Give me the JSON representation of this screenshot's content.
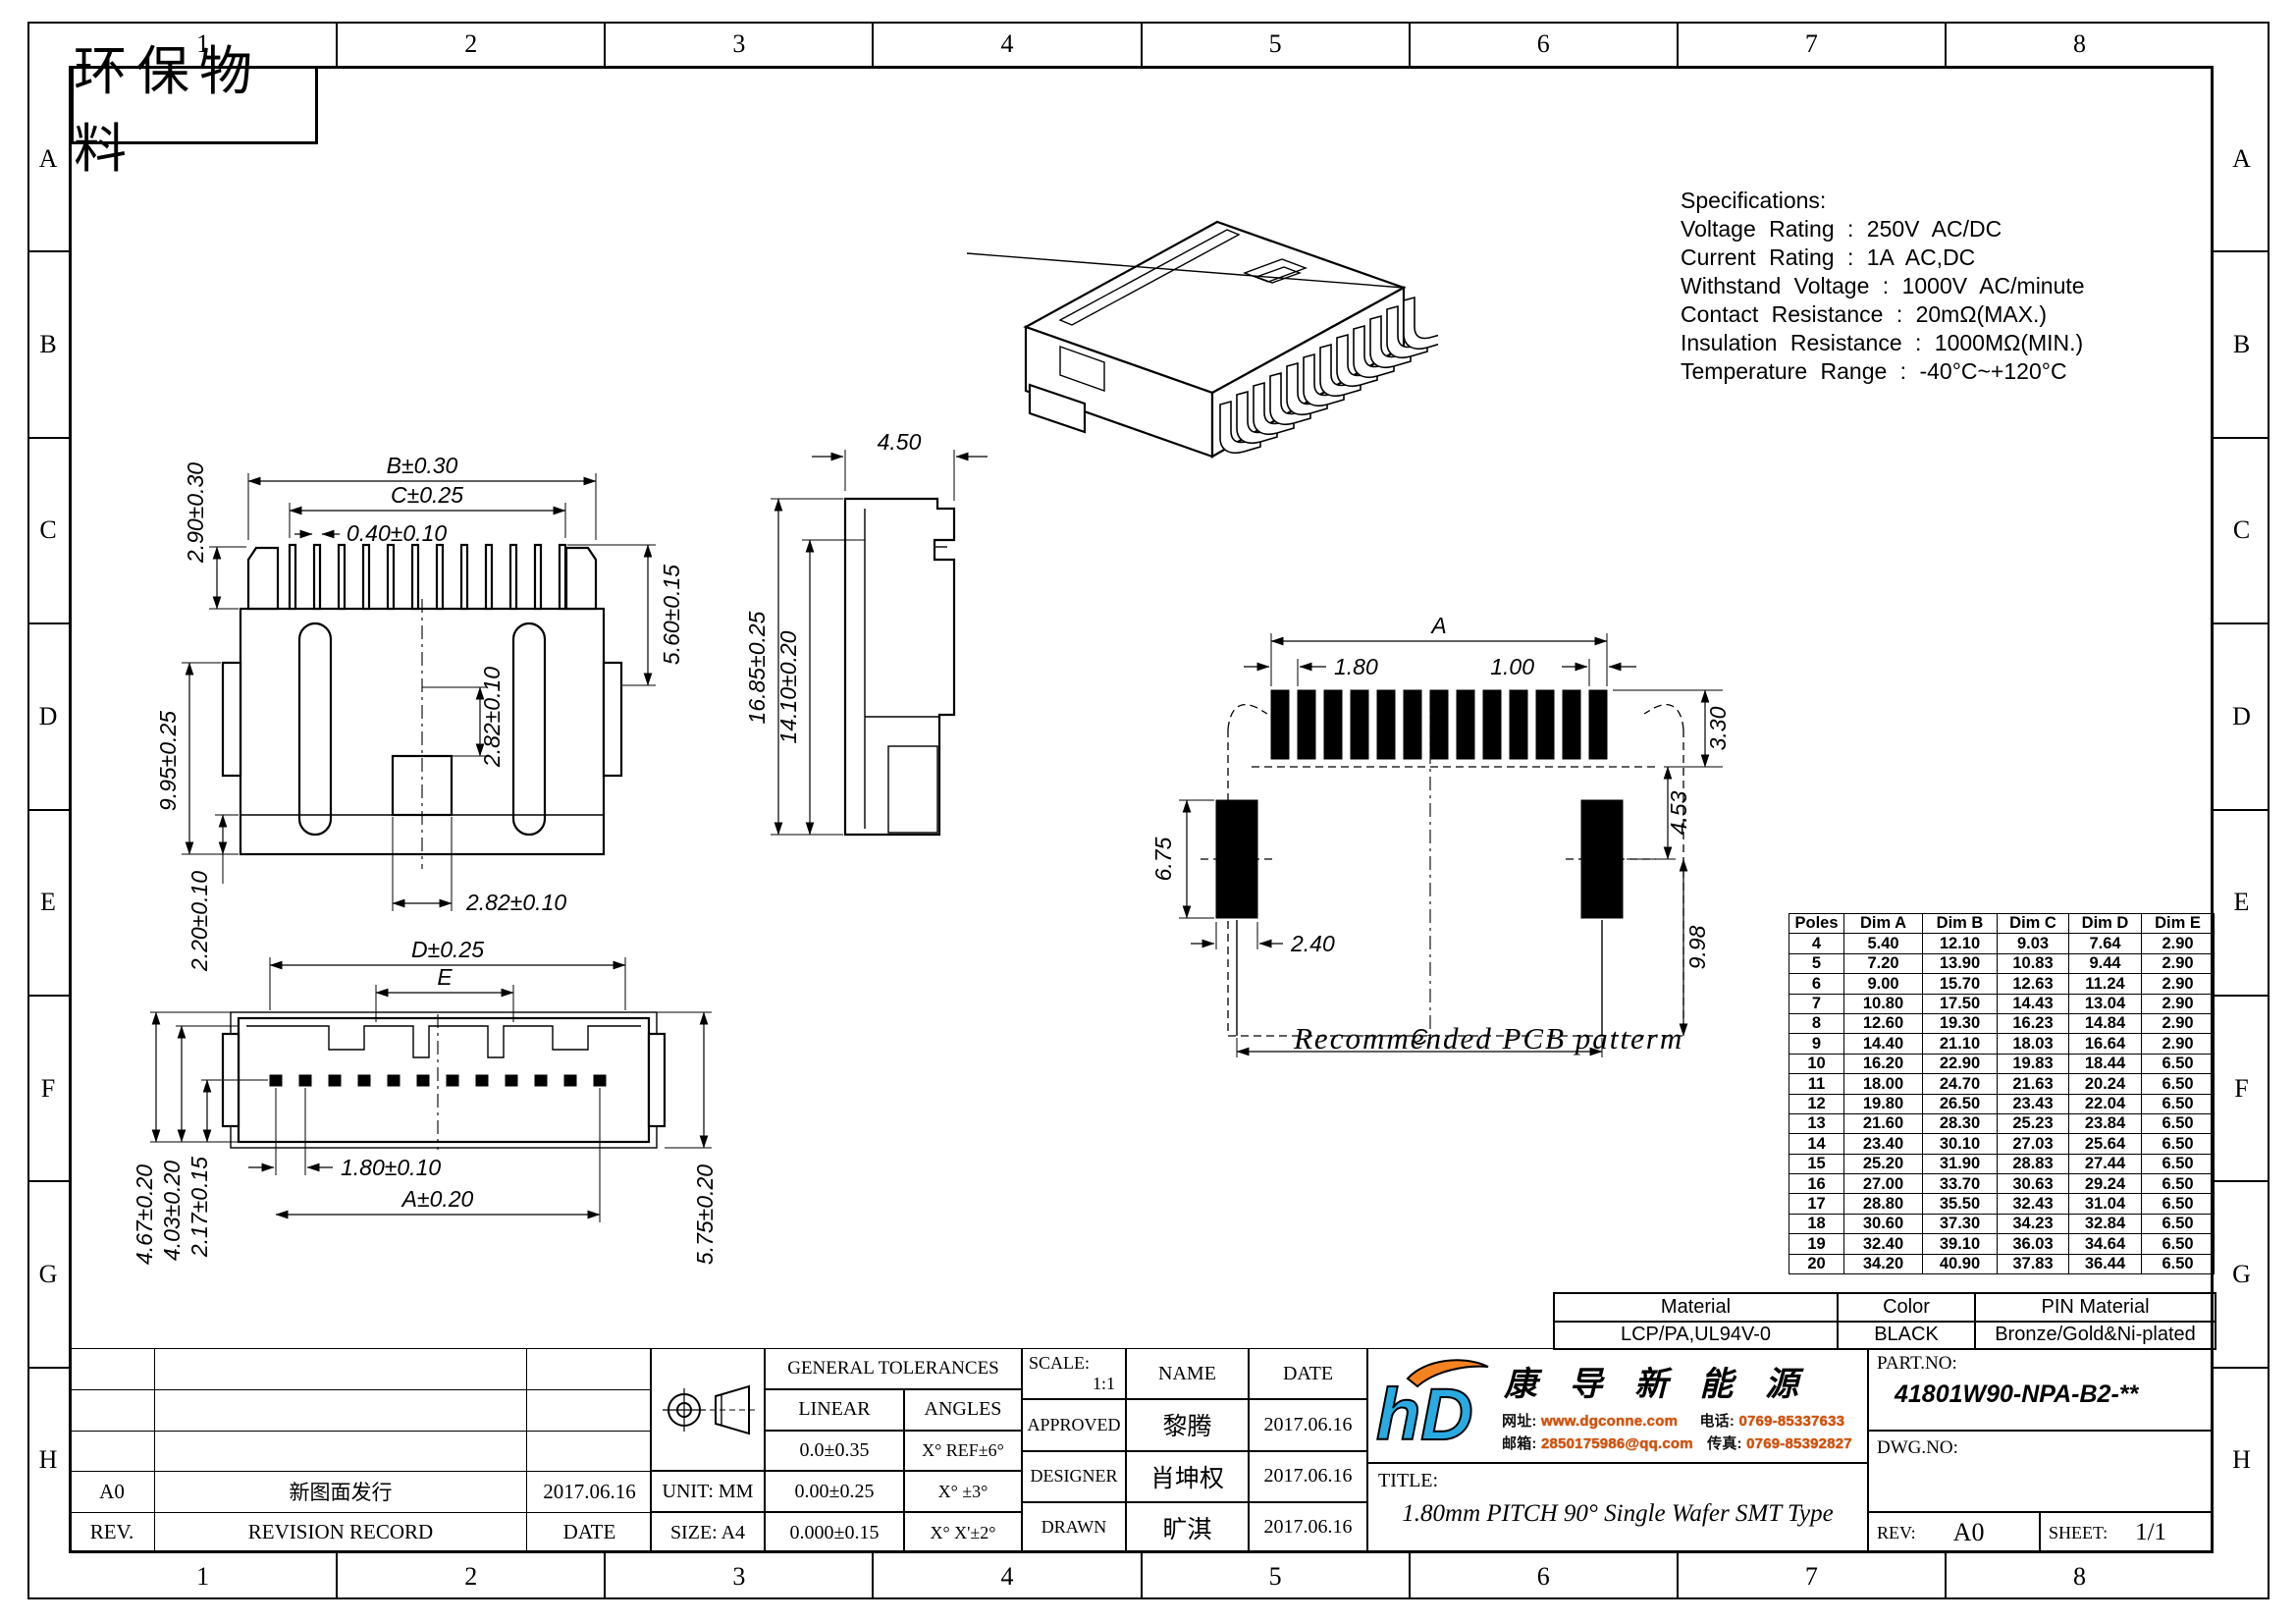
{
  "frame": {
    "columns": [
      "1",
      "2",
      "3",
      "4",
      "5",
      "6",
      "7",
      "8"
    ],
    "rows": [
      "A",
      "B",
      "C",
      "D",
      "E",
      "F",
      "G",
      "H"
    ]
  },
  "stamp": "环保物料",
  "specifications": {
    "title": "Specifications:",
    "lines": [
      "Voltage Rating : 250V AC/DC",
      "Current Rating : 1A AC,DC",
      "Withstand Voltage : 1000V AC/minute",
      "Contact Resistance : 20mΩ(MAX.)",
      "Insulation Resistance : 1000MΩ(MIN.)",
      "Temperature Range : -40°C~+120°C"
    ]
  },
  "views": {
    "front": {
      "dims": {
        "b": "B±0.30",
        "c": "C±0.25",
        "pin_w": "0.40±0.10",
        "top_h": "2.90±0.30",
        "latch_h": "5.60±0.15",
        "slot_v": "2.82±0.10",
        "body_h": "9.95±0.25",
        "foot_h": "2.20±0.10",
        "slot_w": "2.82±0.10"
      }
    },
    "side": {
      "dims": {
        "w": "4.50",
        "h_total": "16.85±0.25",
        "h_inner": "14.10±0.20"
      }
    },
    "bottom": {
      "dims": {
        "d": "D±0.25",
        "e": "E",
        "pitch": "1.80±0.10",
        "a": "A±0.20",
        "v1": "4.67±0.20",
        "v2": "4.03±0.20",
        "v3": "2.17±0.15",
        "v4": "5.75±0.20"
      }
    },
    "pcb": {
      "dims": {
        "a": "A",
        "pitch": "1.80",
        "pad_w": "1.00",
        "pad_h": "3.30",
        "gap": "4.53",
        "side_pad_h": "6.75",
        "side_pad_w": "2.40",
        "depth": "9.98",
        "c": "C"
      },
      "caption": "Recommended PCB patterm"
    }
  },
  "poles_table": {
    "headers": [
      "Poles",
      "Dim A",
      "Dim B",
      "Dim C",
      "Dim D",
      "Dim E"
    ],
    "rows": [
      [
        "4",
        "5.40",
        "12.10",
        "9.03",
        "7.64",
        "2.90"
      ],
      [
        "5",
        "7.20",
        "13.90",
        "10.83",
        "9.44",
        "2.90"
      ],
      [
        "6",
        "9.00",
        "15.70",
        "12.63",
        "11.24",
        "2.90"
      ],
      [
        "7",
        "10.80",
        "17.50",
        "14.43",
        "13.04",
        "2.90"
      ],
      [
        "8",
        "12.60",
        "19.30",
        "16.23",
        "14.84",
        "2.90"
      ],
      [
        "9",
        "14.40",
        "21.10",
        "18.03",
        "16.64",
        "2.90"
      ],
      [
        "10",
        "16.20",
        "22.90",
        "19.83",
        "18.44",
        "6.50"
      ],
      [
        "11",
        "18.00",
        "24.70",
        "21.63",
        "20.24",
        "6.50"
      ],
      [
        "12",
        "19.80",
        "26.50",
        "23.43",
        "22.04",
        "6.50"
      ],
      [
        "13",
        "21.60",
        "28.30",
        "25.23",
        "23.84",
        "6.50"
      ],
      [
        "14",
        "23.40",
        "30.10",
        "27.03",
        "25.64",
        "6.50"
      ],
      [
        "15",
        "25.20",
        "31.90",
        "28.83",
        "27.44",
        "6.50"
      ],
      [
        "16",
        "27.00",
        "33.70",
        "30.63",
        "29.24",
        "6.50"
      ],
      [
        "17",
        "28.80",
        "35.50",
        "32.43",
        "31.04",
        "6.50"
      ],
      [
        "18",
        "30.60",
        "37.30",
        "34.23",
        "32.84",
        "6.50"
      ],
      [
        "19",
        "32.40",
        "39.10",
        "36.03",
        "34.64",
        "6.50"
      ],
      [
        "20",
        "34.20",
        "40.90",
        "37.83",
        "36.44",
        "6.50"
      ]
    ]
  },
  "material_table": {
    "headers": [
      "Material",
      "Color",
      "PIN Material"
    ],
    "values": [
      "LCP/PA,UL94V-0",
      "BLACK",
      "Bronze/Gold&Ni-plated"
    ]
  },
  "title_block": {
    "headers": {
      "rev": "REV.",
      "record": "REVISION RECORD",
      "date": "DATE"
    },
    "revision": {
      "rev": "A0",
      "record": "新图面发行",
      "date": "2017.06.16"
    },
    "unit": "UNIT: MM",
    "size": "SIZE: A4",
    "tolerances": {
      "title": "GENERAL TOLERANCES",
      "linear": "LINEAR",
      "angles": "ANGLES",
      "linear_values": [
        "0.0±0.35",
        "0.00±0.25",
        "0.000±0.15"
      ],
      "angle_values": [
        "X° REF±6°",
        "X° ±3°",
        "X° X'±2°"
      ]
    },
    "scale_label": "SCALE:",
    "scale": "1:1",
    "name_header": "NAME",
    "date_header": "DATE",
    "approvals": [
      {
        "role": "APPROVED",
        "name": "黎腾",
        "date": "2017.06.16"
      },
      {
        "role": "DESIGNER",
        "name": "肖坤权",
        "date": "2017.06.16"
      },
      {
        "role": "DRAWN",
        "name": "旷淇",
        "date": "2017.06.16"
      }
    ],
    "company": {
      "name": "康 导 新 能 源",
      "web_label": "网址:",
      "web": "www.dgconne.com",
      "tel_label": "电话:",
      "tel": "0769-85337633",
      "mail_label": "邮箱:",
      "mail": "2850175986@qq.com",
      "fax_label": "传真:",
      "fax": "0769-85392827"
    },
    "title_label": "TITLE:",
    "title": "1.80mm PITCH 90° Single Wafer SMT Type",
    "part_no_label": "PART.NO:",
    "part_no": "41801W90-NPA-B2-**",
    "dwg_no_label": "DWG.NO:",
    "rev_label": "REV:",
    "rev": "A0",
    "sheet_label": "SHEET:",
    "sheet": "1/1"
  },
  "colors": {
    "logo_blue": "#29abe2",
    "logo_orange": "#f58220",
    "contact_accent": "#d94f00"
  }
}
